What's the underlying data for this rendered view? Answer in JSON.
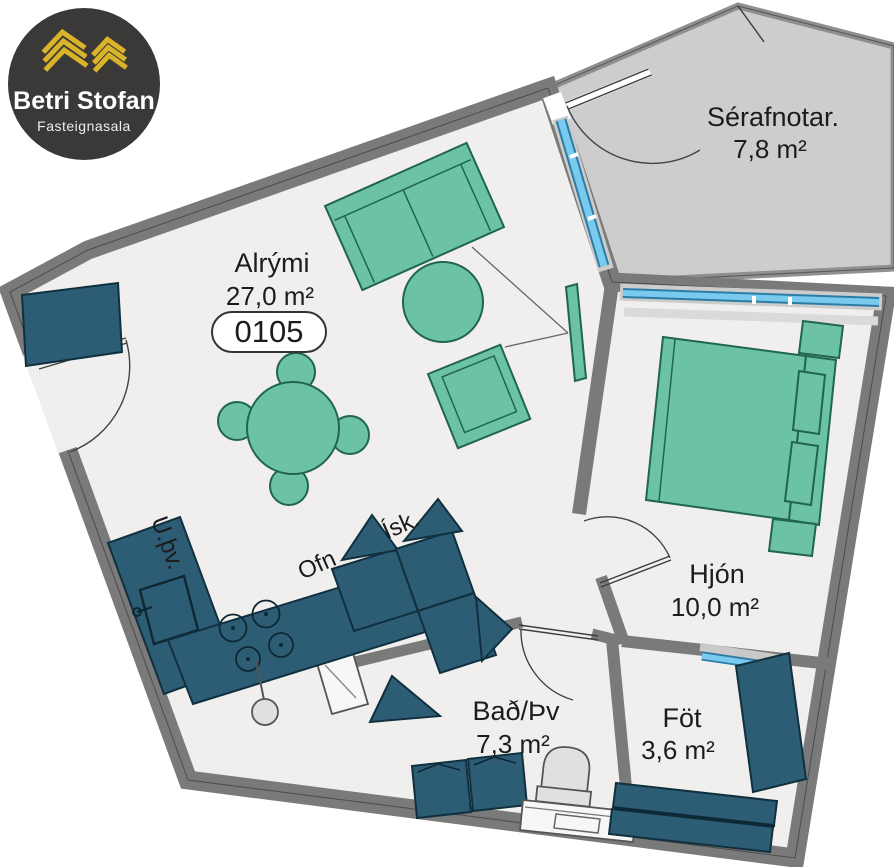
{
  "logo": {
    "brand": "Betri Stofan",
    "tagline": "Fasteignasala"
  },
  "floorplan": {
    "unit_number": "0105",
    "rooms": {
      "alrymi": {
        "name": "Alrými",
        "area": "27,0 m²"
      },
      "serafnotar": {
        "name": "Sérafnotar.",
        "area": "7,8 m²"
      },
      "hjon": {
        "name": "Hjón",
        "area": "10,0 m²"
      },
      "bad": {
        "name": "Bað/Þv",
        "area": "7,3 m²"
      },
      "fot": {
        "name": "Föt",
        "area": "3,6 m²"
      }
    },
    "labels": {
      "uthv": "U.þv.",
      "ofn": "Ofn",
      "isk": "Ísk."
    }
  },
  "colors": {
    "wall_gray": "#7a7a7a",
    "balcony_wall_gray": "#8f8f8f",
    "floor": "#f0efed",
    "balcony_floor": "#cdcdcd",
    "furniture_green": "#6cc3a4",
    "furniture_green_border": "#20654c",
    "cabinet_blue": "#2d5c75",
    "glass_blue": "#7ac9ee",
    "logo_background": "#3b3937",
    "logo_gold": "#d9b32a",
    "label_text": "#1c1c1c"
  }
}
